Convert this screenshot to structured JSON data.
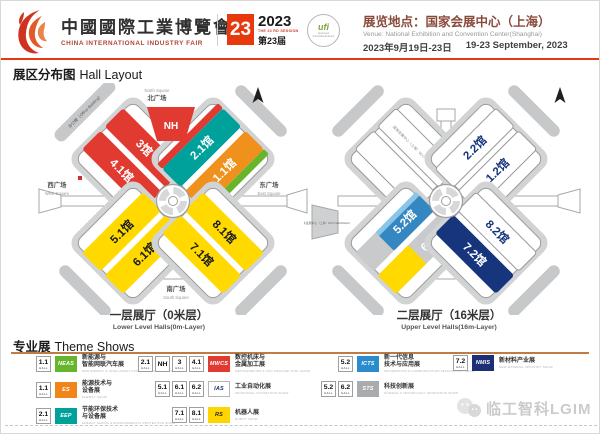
{
  "header": {
    "logo": {
      "title_zh": "中國國際工業博覽會",
      "title_en": "CHINA INTERNATIONAL INDUSTRY FAIR"
    },
    "session": {
      "number": "23",
      "year": "2023",
      "session_en": "THE 23 RD SESSION",
      "session_zh": "第23届"
    },
    "ufi": {
      "label": "ufi",
      "sub": "Approved International Event"
    },
    "venue": {
      "line_zh": "展览地点：国家会展中心（上海）",
      "line_en": "Venue: National Exhibition and Convention Center(Shanghai)",
      "date_zh": "2023年9月19日-23日",
      "date_en": "19-23 September, 2023"
    }
  },
  "section_title": {
    "zh": "展区分布图",
    "en": "Hall Layout"
  },
  "maps": {
    "lower": {
      "caption_zh": "一层展厅（0米层）",
      "caption_en": "Lower Level Halls(0m-Layer)",
      "office_label": "办公楼（Office Building）",
      "squares": {
        "north_zh": "北广场",
        "north_en": "North Square",
        "west_zh": "西广场",
        "west_en": "West Square",
        "east_zh": "东广场",
        "east_en": "East Square",
        "south_zh": "南广场",
        "south_en": "South Square"
      },
      "halls": {
        "h3": "3馆",
        "h41": "4.1馆",
        "nh": "NH",
        "h21": "2.1馆",
        "h11": "1.1馆",
        "h51": "5.1馆",
        "h61": "6.1馆",
        "h81": "8.1馆",
        "h71": "7.1馆"
      }
    },
    "upper": {
      "caption_zh": "二层展厅（16米层）",
      "caption_en": "Upper Level Halls(16m-Layer)",
      "ncc_label": "国家会展中心（上海）NCC-SHANGHAI",
      "halls": {
        "h22": "2.2馆",
        "h12": "1.2馆",
        "h52": "5.2馆",
        "h62": "6.2馆",
        "h82": "8.2馆",
        "h72": "7.2馆"
      }
    }
  },
  "theme_shows": {
    "title_zh": "专业展",
    "title_en": "Theme Shows",
    "hall_suffix": "HALL",
    "items": [
      {
        "halls": [
          "1.1"
        ],
        "logo": "NEAS",
        "logo_style": "background:#67b42d;color:#fff",
        "name_line1": "新能源与",
        "name_line2": "智能网联汽车展",
        "en": "NEW ENERGY & INTELLIGENT CONNECTED VEHICLES SHOW"
      },
      {
        "halls": [
          "1.1"
        ],
        "logo": "ES",
        "logo_style": "background:#f08519;color:#fff",
        "name_line1": "能源技术与",
        "name_line2": "设备展",
        "en": "ENERGY SHOW"
      },
      {
        "halls": [
          "2.1"
        ],
        "logo": "EEP",
        "logo_style": "background:#00a19b;color:#fff",
        "name_line1": "节能环保技术",
        "name_line2": "与设备展",
        "en": "ENERGY SAVING & ENVIRONMENTAL PROTECTION SHOW"
      },
      {
        "halls": [
          "2.1",
          "NH",
          "3",
          "4.1"
        ],
        "logo": "MWCS",
        "logo_style": "background:#e13a31;color:#fff",
        "name_line1": "数控机床与",
        "name_line2": "金属加工展",
        "en": "METALWORKING & CNC MACHINE TOOL SHOW"
      },
      {
        "halls": [
          "5.1",
          "6.1",
          "6.2"
        ],
        "logo": "IAS",
        "logo_style": "background:#fff;color:#1d2f66;border:0.5px solid #b5b5b5",
        "name_line1": "工业自动化展",
        "name_line2": "",
        "en": "INDUSTRIAL AUTOMATION SHOW"
      },
      {
        "halls": [
          "7.1",
          "8.1"
        ],
        "logo": "RS",
        "logo_style": "background:#ffd500;color:#222",
        "name_line1": "机器人展",
        "name_line2": "",
        "en": "ROBOT SHOW"
      },
      {
        "halls": [
          "5.2"
        ],
        "logo": "ICTS",
        "logo_style": "background:#2b8ccd;color:#fff",
        "name_line1": "新一代信息",
        "name_line2": "技术与应用展",
        "en": "INFORMATION & COMMUNICATION TECHNOLOGY SHOW"
      },
      {
        "halls": [
          "5.2",
          "6.2"
        ],
        "logo": "STS",
        "logo_style": "background:#a9abad;color:#fff",
        "name_line1": "科技创新展",
        "name_line2": "",
        "en": "SCIENCE & TECHNOLOGY INNOVATION SHOW"
      },
      {
        "halls": [
          "7.2"
        ],
        "logo": "NMIS",
        "logo_style": "background:#1d3076;color:#fff",
        "name_line1": "新材料产业展",
        "name_line2": "",
        "en": "NEW MATERIAL INDUSTRY SHOW"
      }
    ]
  },
  "watermark": {
    "text": "临工智科LGIM"
  },
  "colors": {
    "red": "#e13a31",
    "teal": "#00a19b",
    "orange": "#f0911e",
    "green": "#67b42d",
    "yellow": "#ffd900",
    "blue": "#3487c0",
    "light_blue": "#8ac6ea",
    "navy": "#17357d",
    "gray_hall": "#c9cacb",
    "accent": "#e8380d",
    "rule_brown": "#bd7b48"
  }
}
